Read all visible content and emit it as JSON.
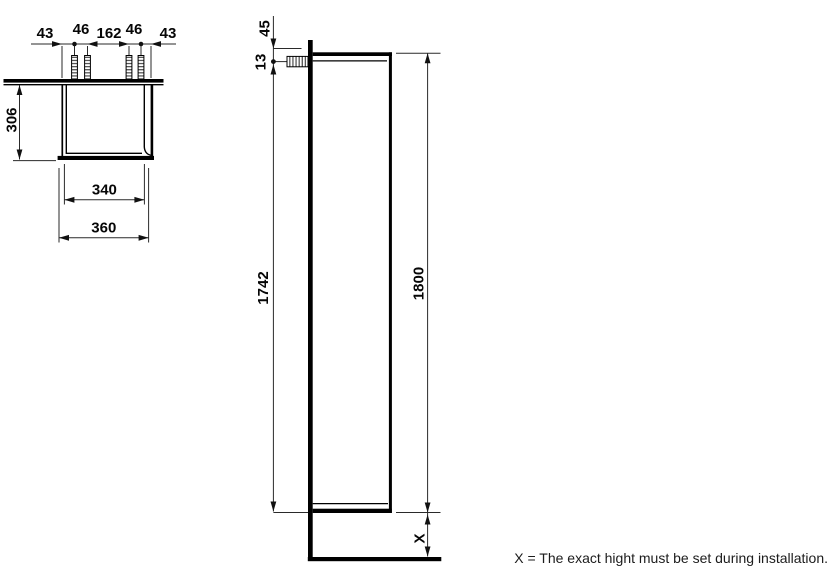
{
  "top_view": {
    "spacing_chain": [
      "43",
      "46",
      "162",
      "46",
      "43"
    ],
    "depth": "306",
    "inner_width": "340",
    "outer_width": "360"
  },
  "side_view": {
    "top_offset": "45",
    "screw_offset": "13",
    "carcass_height": "1742",
    "total_height": "1800",
    "floor_clearance": "X"
  },
  "footnote": "X = The exact hight must be set during installation.",
  "colors": {
    "line": "#000000",
    "dim": "#2a2a2a",
    "background": "#ffffff"
  }
}
